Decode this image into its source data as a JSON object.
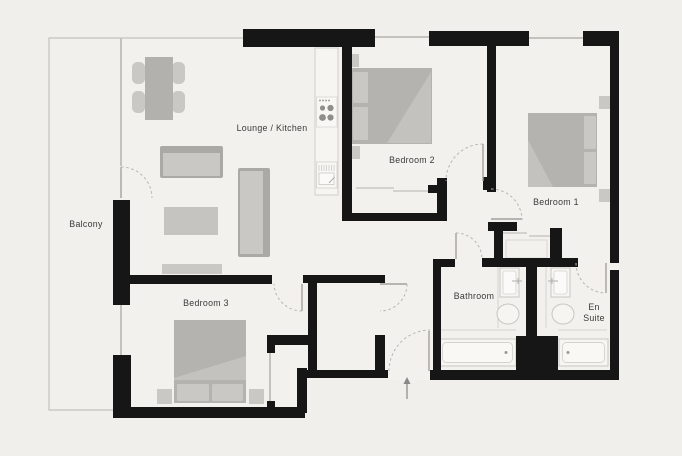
{
  "floorplan": {
    "labels": {
      "balcony": "Balcony",
      "lounge_kitchen": "Lounge / Kitchen",
      "bedroom1": "Bedroom 1",
      "bedroom2": "Bedroom 2",
      "bedroom3": "Bedroom 3",
      "bathroom": "Bathroom",
      "ensuite_line1": "En",
      "ensuite_line2": "Suite"
    },
    "icons": {
      "entrance_arrow": "arrow-up-entrance",
      "hob": "4-ring-hob",
      "sink": "kitchen-sink"
    },
    "colors": {
      "background": "#f1efec",
      "wall": "#161616",
      "furniture": "#b4b3b0",
      "furniture_light": "#c9c8c5",
      "fixture_fill": "#f6f5f2",
      "fixture_outline": "#c8c6c2",
      "door_arc": "#b7b5b1",
      "label_text": "#3a3a3a"
    }
  }
}
